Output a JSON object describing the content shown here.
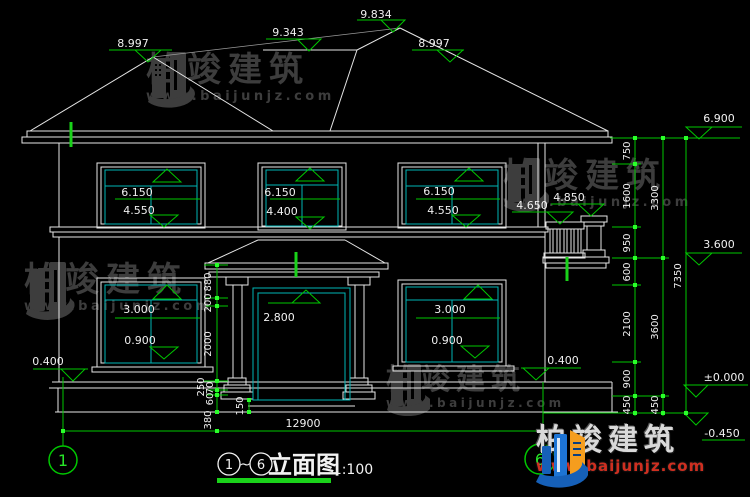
{
  "watermark": {
    "brand": "柏竣建筑",
    "url": "www.baijunjz.com"
  },
  "brand_logo": {
    "brand": "柏竣建筑",
    "url": "www.baijunjz.com"
  },
  "title": {
    "axis_from": "1",
    "tilde": "~",
    "axis_to": "6",
    "name": "立面图",
    "scale": "1:100"
  },
  "axes": {
    "left": "1",
    "right": "6"
  },
  "levels": {
    "ridge_main": "9.834",
    "ridge_rear": "9.343",
    "ridge_left": "8.997",
    "slope_right": "8.997",
    "eave": "6.900",
    "floor2": "3.600",
    "zero": "±0.000",
    "foundation": "-0.450",
    "terrace_left": "0.400",
    "terrace_right": "0.400",
    "balcony_pillar": "4.850",
    "balcony_rail": "4.650"
  },
  "openings": {
    "f2w1": {
      "lintel": "6.150",
      "sill": "4.550"
    },
    "f2w2": {
      "lintel": "6.150",
      "sill": "4.400"
    },
    "f2w3": {
      "lintel": "6.150",
      "sill": "4.550"
    },
    "f1w1": {
      "lintel": "3.000",
      "sill": "0.900"
    },
    "f1w2": {
      "lintel": "3.000",
      "sill": "0.900"
    },
    "door": {
      "lintel": "2.800"
    }
  },
  "dims": {
    "right_col1": [
      "750",
      "1600",
      "950",
      "600",
      "2100",
      "900",
      "450"
    ],
    "right_col2": [
      "3300",
      "3600",
      "450"
    ],
    "right_total": "7350",
    "left_chain": [
      "880",
      "200",
      "2000",
      "250",
      "70",
      "60"
    ],
    "left_sub": "380",
    "step": "150",
    "width_total": "12900"
  }
}
